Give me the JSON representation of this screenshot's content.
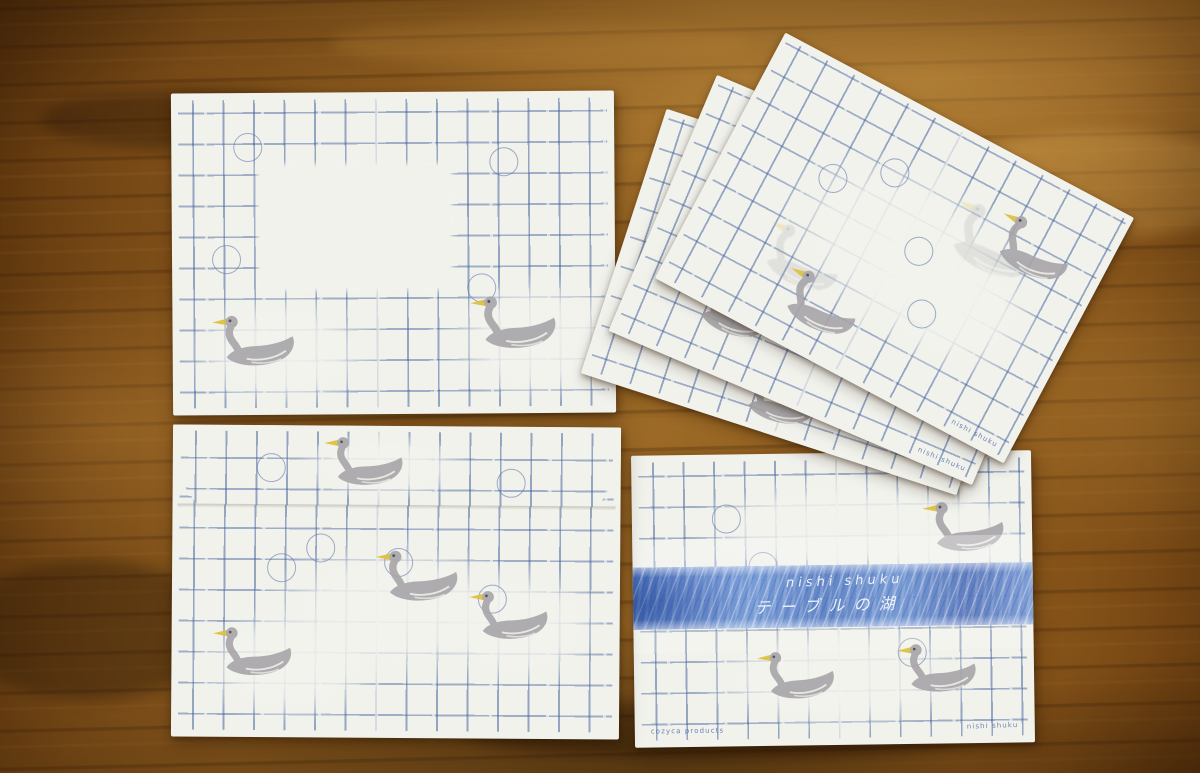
{
  "product": {
    "band_title": "nishi shuku",
    "band_subtitle": "テーブルの湖"
  },
  "prints": {
    "brand": "cozyca products",
    "artist": "nishi shuku"
  },
  "palette": {
    "wood": "#7c4c16",
    "wood_dark": "#42260a",
    "wood_light": "#c49048",
    "paper": "#f1f2ec",
    "grid_blue": "#4f6ea6",
    "swan_gray": "#a7a5a9",
    "beak_yellow": "#dfc038",
    "eye_dark": "#45423f",
    "band_blue": "#5b80c4",
    "band_text": "#eef3fb"
  },
  "icons": {
    "swan": "swan-stamp-icon",
    "ghost_swan": "swan-ghost-icon",
    "circle": "circle-motif-icon"
  }
}
